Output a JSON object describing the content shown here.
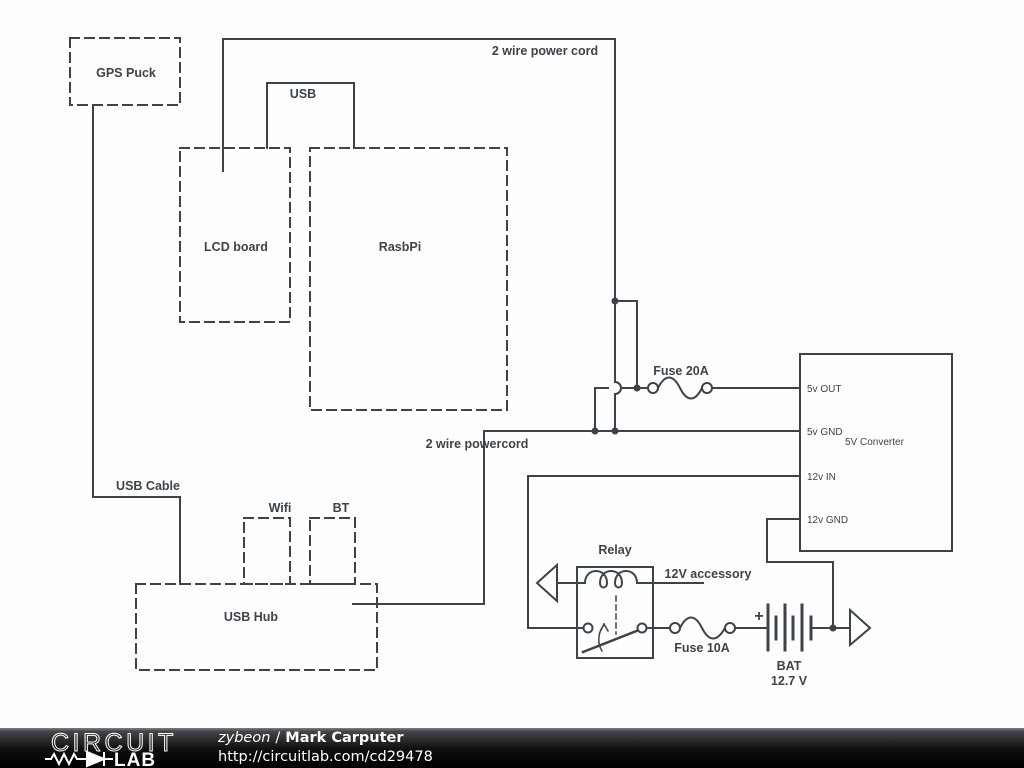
{
  "diagram": {
    "labels": {
      "gps_puck": "GPS Puck",
      "power_cord_top": "2 wire power cord",
      "usb": "USB",
      "lcd_board": "LCD board",
      "rasbpi": "RasbPi",
      "fuse_20a": "Fuse 20A",
      "powercord_mid": "2 wire powercord",
      "usb_cable": "USB Cable",
      "wifi": "Wifi",
      "bt": "BT",
      "usb_hub": "USB Hub",
      "relay": "Relay",
      "accessory_12v": "12V accessory",
      "fuse_10a": "Fuse 10A",
      "plus": "+",
      "bat_name": "BAT",
      "bat_voltage": "12.7 V"
    },
    "converter": {
      "name": "5V Converter",
      "pins": {
        "p1": "5v OUT",
        "p2": "5v GND",
        "p3": "12v IN",
        "p4": "12v GND"
      }
    },
    "colors": {
      "wire": "#3c434a",
      "background": "#fefefe",
      "footer_bg": "#000000"
    }
  },
  "footer": {
    "brand_top": "CIRCUIT",
    "brand_bottom": "LAB",
    "author": "zybeon",
    "separator": "/",
    "title": "Mark Carputer",
    "url": "http://circuitlab.com/cd29478"
  }
}
